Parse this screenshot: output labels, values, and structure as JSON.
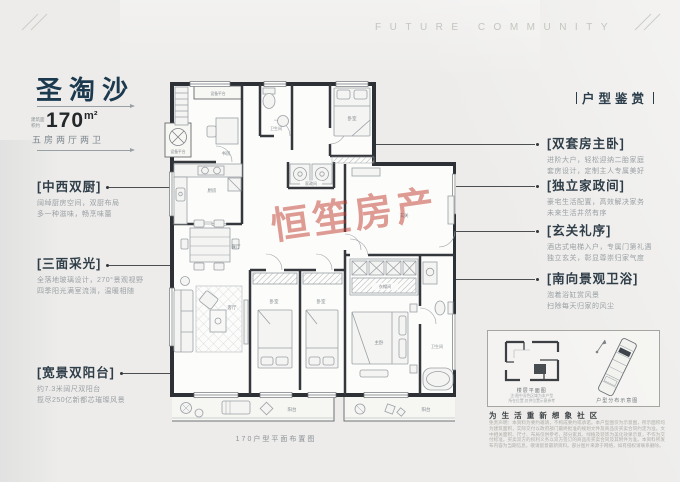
{
  "header": {
    "future_community": "FUTURE COMMUNITY",
    "appreciation_label": "户型鉴赏"
  },
  "title_block": {
    "name": "圣淘沙",
    "area_prefix": "建筑面积约",
    "area_value": "170",
    "area_unit": "m²",
    "layout_desc": "五房两厅两卫"
  },
  "left_annotations": [
    {
      "title": "[中西双厨]",
      "line1": "阔绰厨房空间，双厨布局",
      "line2": "多一种滋味，畅烹味蕾"
    },
    {
      "title": "[三面采光]",
      "line1": "全落地玻璃设计，270°景观视野",
      "line2": "四季阳光满室流淌，温暖相随"
    },
    {
      "title": "[宽景双阳台]",
      "line1": "约7.3米阔尺双阳台",
      "line2": "揽尽250亿新都芯璀璨风景"
    }
  ],
  "right_annotations": [
    {
      "title": "[双套房主卧]",
      "line1": "进阶大户，轻松迎纳二胎家庭",
      "line2": "套房设计，定制主人专属美好"
    },
    {
      "title": "[独立家政间]",
      "line1": "豪宅生活配置，高效解决家务",
      "line2": "未来生活井然有序"
    },
    {
      "title": "[玄关礼序]",
      "line1": "酒店式电梯入户，专属门第礼遇",
      "line2": "独立玄关，彰显尊崇归家气度"
    },
    {
      "title": "[南向景观卫浴]",
      "line1": "泡着浴缸赏风景",
      "line2": "扫除每天归家的风尘"
    }
  ],
  "floorplan": {
    "caption": "170户型平面布置图",
    "watermark": "恒笙房产",
    "rooms": {
      "equip_top": "设备平台",
      "equip_left": "设备平台",
      "study": "书房",
      "bath1": "卫生间",
      "bedroom_ne": "卧室",
      "laundry": "家政间",
      "kitchen": "厨房",
      "dining": "餐厅",
      "living": "客厅",
      "bedroom_s1": "卧室",
      "bedroom_s2": "卧室",
      "master": "主卧",
      "closet": "衣帽间",
      "bath2": "卫生间",
      "entry": "玄关",
      "balcony_sw": "阳台",
      "balcony_se": "阳台"
    }
  },
  "inset": {
    "floor_caption": "楼层平面图",
    "floor_note1": "注:图中深色区域为本户型",
    "floor_note2": "所在位置,仅供位置示意参考",
    "dist_caption": "户型分布示意图"
  },
  "footer": {
    "slogan": "为 生 活  重 新 想 象 社 区",
    "disclaimer": "免责声明：本资料为要约邀请，不构成要约或承诺。本户型图仅为示意图，所示面积均为建筑面积，实际交付以政府部门最终批准的规划文件及商品房买卖合同约定为准。文中相关面积、尺寸、布局仅供参考，部分家具、绿植及装饰为美化效果示意，不作为交付标准。买卖双方的权利义务以双方签订的商品房买卖合同及其附件为准。本资料所发布内容为当期信息，敬请留意最新资料。部分图片来源于网络，如有侵权请联系删除。"
  }
}
